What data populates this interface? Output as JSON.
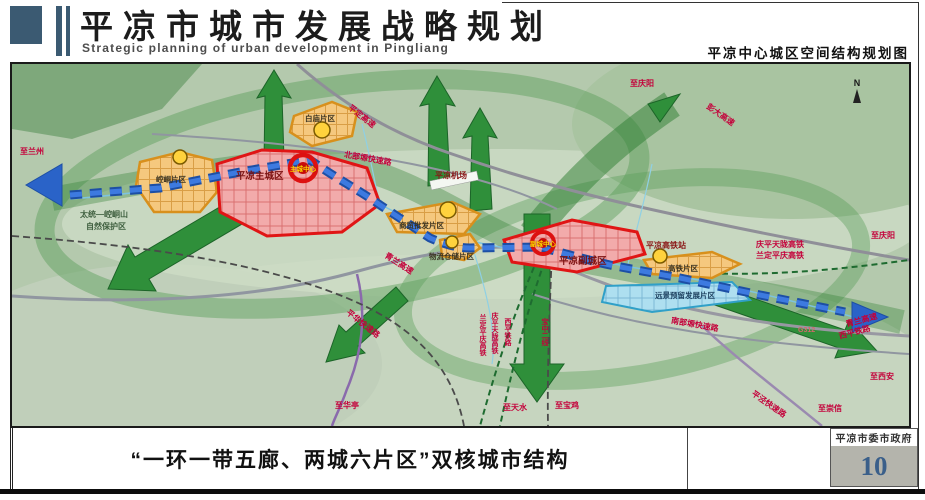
{
  "header": {
    "title": "平凉市城市发展战略规划",
    "subtitle": "Strategic planning of urban development in Pingliang",
    "map_title": "平凉中心城区空间结构规划图"
  },
  "footer": {
    "caption": "“一环一带五廊、两城六片区”双核城市结构",
    "agency": "平凉市委市政府",
    "page_number": "10"
  },
  "map": {
    "compass_label": "N",
    "cities": {
      "main": "平凉主城区",
      "sub": "平凉副城区"
    },
    "cores": {
      "main": "主城中心",
      "sub": "副城中心"
    },
    "districts": {
      "kongtong": "崆峒片区",
      "baimiao": "白庙片区",
      "shangmao": "商贸批发片区",
      "wuliu": "物流仓储片区",
      "gaotie": "高铁片区",
      "yuanjing": "远景预留发展片区"
    },
    "reserve": {
      "line1": "太统—崆峒山",
      "line2": "自然保护区"
    },
    "stations": {
      "airport": "平凉机场",
      "hsr": "平凉高铁站"
    },
    "roads": {
      "pingding": "平定高速",
      "beibuyuan": "北部塬快速路",
      "qinglan": "青兰高速",
      "nanbuyuan": "南部塬快速路",
      "pinghua": "平华快速路",
      "pingjing": "平泾快速路",
      "g312": "G312",
      "pengda": "彭大高速"
    },
    "railways": {
      "qptl": "庆平天陇高铁",
      "ldpq": "兰定平庆高铁",
      "xiping": "西平铁路",
      "baozhong": "宝中二线"
    },
    "directions": {
      "lanzhou": "至兰州",
      "qingyang": "至庆阳",
      "xian": "至西安",
      "chongxin": "至崇信",
      "huating": "至华亭",
      "tianshui": "至天水",
      "baoji": "至宝鸡"
    }
  },
  "colors": {
    "header_accent": "#3b5a72",
    "core_red": "#d01010",
    "city_fill": "#f2abab",
    "district_orange": "#f5c87e",
    "reserve_blue": "#aedff0",
    "corridor_green": "#2f8f3a",
    "belt_blue": "#2a63c8",
    "road_label_red": "#c4003a",
    "page_number_blue": "#3a5f8a"
  }
}
